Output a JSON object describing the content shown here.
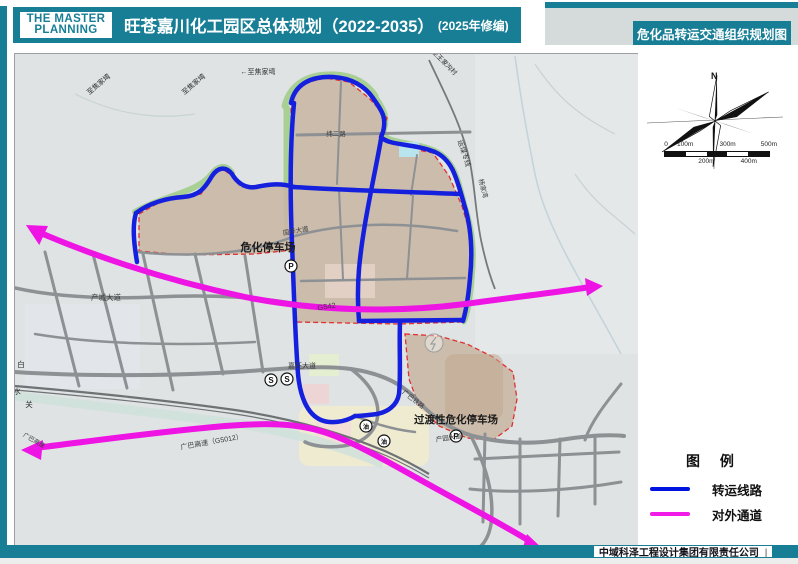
{
  "header": {
    "logo_line1": "THE MASTER",
    "logo_line2": "PLANNING",
    "title": "旺苍嘉川化工园区总体规划（2022-2035）",
    "subtitle": "(2025年修编)",
    "right_title": "危化品转运交通组织规划图"
  },
  "footer": {
    "company": "中域科泽工程设计集团有限责任公司",
    "divider": "|"
  },
  "panel": {
    "compass_n": "N",
    "scale": {
      "top": [
        "0",
        "100m",
        "300m",
        "500m"
      ],
      "bottom": [
        "200m",
        "400m"
      ]
    },
    "legend": {
      "title": "图 例",
      "items": [
        {
          "label": "转运线路",
          "color": "#0014e0"
        },
        {
          "label": "对外通道",
          "color": "#f21ae6"
        }
      ]
    }
  },
  "map": {
    "colors": {
      "transfer_route": "#1420dd",
      "external_channel": "#ee14e4",
      "park_fill": "#c9b7a5",
      "park_boundary": "#e03030",
      "green_edge": "#a8d095",
      "road": "#8d9194"
    },
    "labels": [
      {
        "text": "危化停车场",
        "x": 253,
        "y": 197,
        "size": 11,
        "bold": true,
        "color": "#1a1a1a"
      },
      {
        "text": "过渡性危化停车场",
        "x": 441,
        "y": 369,
        "size": 10.5,
        "bold": true,
        "color": "#1a1a1a"
      },
      {
        "text": "产城大道",
        "x": 91,
        "y": 246,
        "size": 7.5,
        "color": "#3a3a3a"
      },
      {
        "text": "嘉旺大道",
        "x": 287,
        "y": 314,
        "size": 7,
        "color": "#3a3a3a"
      },
      {
        "text": "广巴高速（G5012）",
        "x": 197,
        "y": 390,
        "size": 7,
        "color": "#3a3a3a",
        "rotate": -10
      },
      {
        "text": "G542",
        "x": 312,
        "y": 255,
        "size": 7.5,
        "color": "#3a3a3a",
        "rotate": -9
      },
      {
        "text": "广巴铁路",
        "x": 397,
        "y": 347,
        "size": 6.5,
        "color": "#3a3a3a",
        "rotate": 38
      },
      {
        "text": "国华大道",
        "x": 281,
        "y": 179,
        "size": 6.5,
        "color": "#3a3a3a",
        "rotate": -10
      },
      {
        "text": "纬二路",
        "x": 321,
        "y": 82,
        "size": 6.5,
        "color": "#3a3a3a"
      },
      {
        "text": "运煤专线",
        "x": 447,
        "y": 100,
        "size": 7,
        "color": "#3a3a3a",
        "rotate": 72
      },
      {
        "text": "杨家湾",
        "x": 466,
        "y": 135,
        "size": 6.5,
        "color": "#3a3a3a",
        "rotate": 75
      },
      {
        "text": "←至焦家塆",
        "x": 243,
        "y": 20,
        "size": 7,
        "color": "#2a2a2a"
      },
      {
        "text": "至焦家塆",
        "x": 180,
        "y": 32,
        "size": 7,
        "color": "#2a2a2a",
        "rotate": -40
      },
      {
        "text": "至焦家塆",
        "x": 85,
        "y": 32,
        "size": 7,
        "color": "#2a2a2a",
        "rotate": -40
      },
      {
        "text": "至王家沟村",
        "x": 428,
        "y": 10,
        "size": 6.5,
        "color": "#2a2a2a",
        "rotate": 45
      },
      {
        "text": "白",
        "x": 6,
        "y": 313,
        "size": 7.5,
        "color": "#2a2a2a"
      },
      {
        "text": "水",
        "x": 2,
        "y": 340,
        "size": 7.5,
        "color": "#2a2a2a"
      },
      {
        "text": "关",
        "x": 14,
        "y": 353,
        "size": 7.5,
        "color": "#2a2a2a"
      },
      {
        "text": "广巴高速",
        "x": 18,
        "y": 388,
        "size": 6,
        "color": "#3a3a3a",
        "rotate": 30
      },
      {
        "text": "产园大道",
        "x": 434,
        "y": 386,
        "size": 6.5,
        "color": "#3a3a3a",
        "rotate": -8
      }
    ],
    "markers": [
      {
        "symbol": "P",
        "x": 276,
        "y": 212
      },
      {
        "symbol": "P",
        "x": 441,
        "y": 382
      },
      {
        "symbol": "S",
        "x": 256,
        "y": 326
      },
      {
        "symbol": "S",
        "x": 272,
        "y": 325
      },
      {
        "symbol": "油",
        "x": 351,
        "y": 372
      },
      {
        "symbol": "油",
        "x": 369,
        "y": 387
      }
    ]
  }
}
